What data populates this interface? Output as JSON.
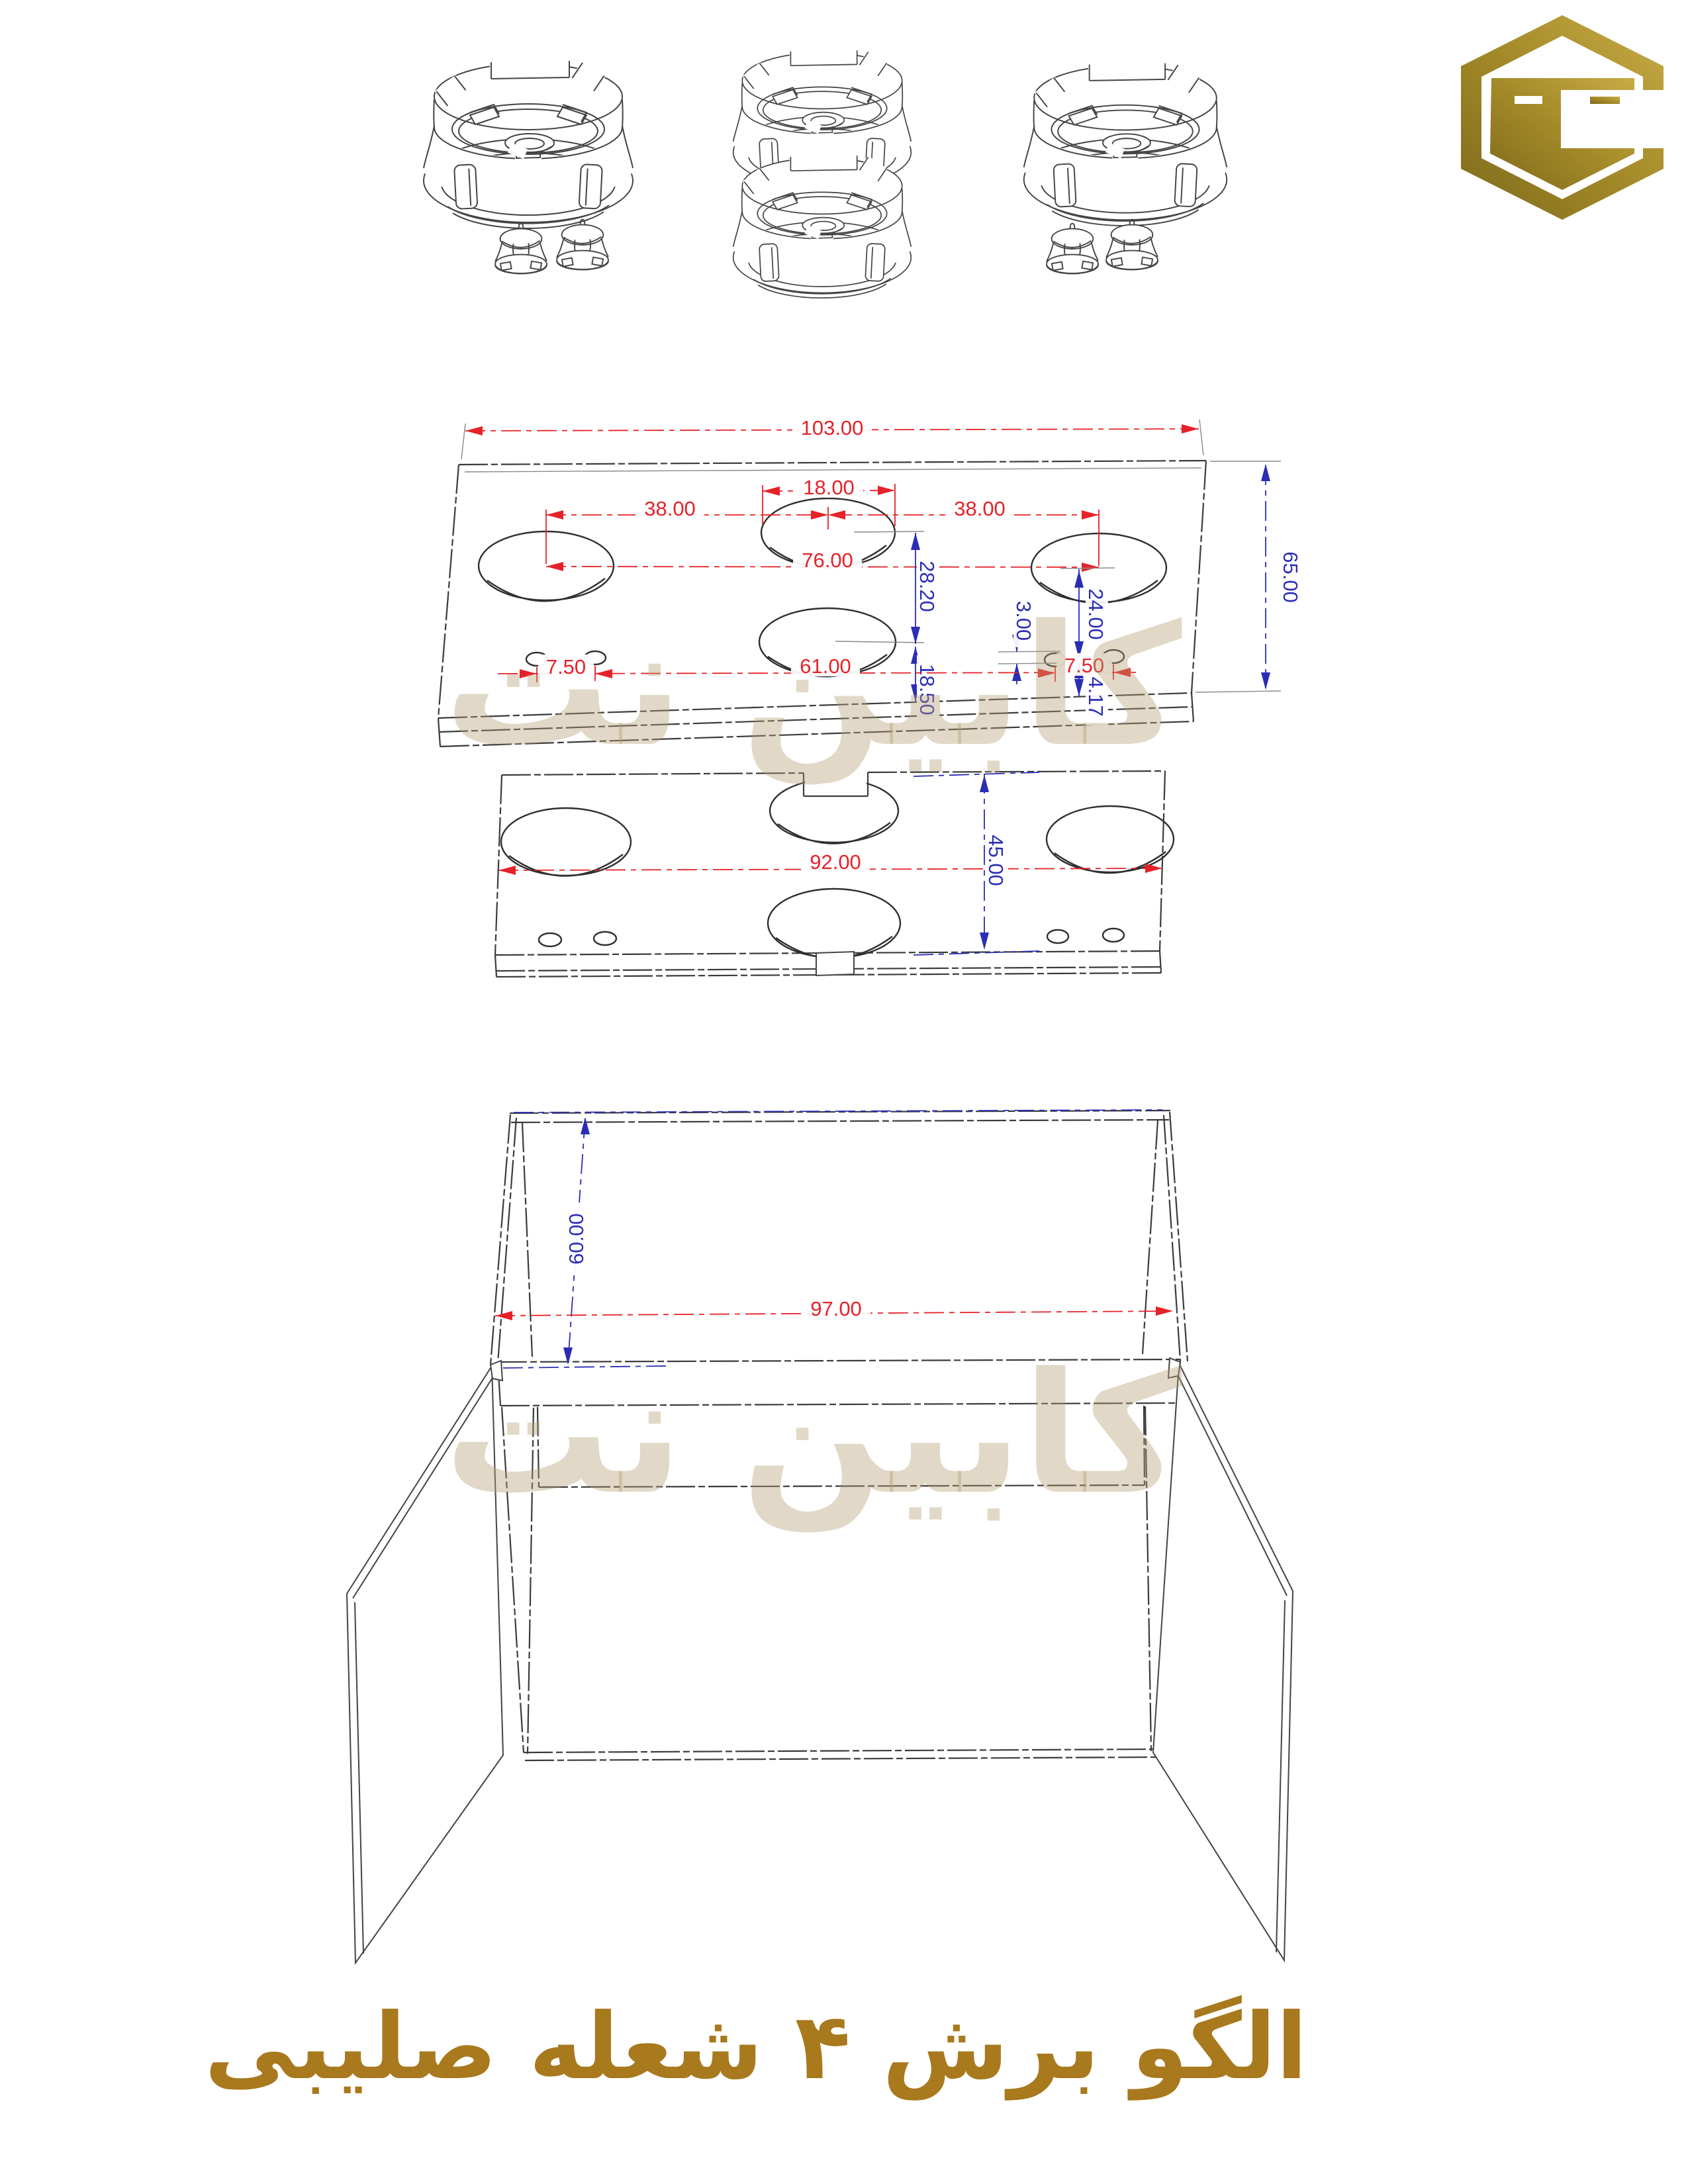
{
  "page": {
    "background": "#ffffff"
  },
  "logo": {
    "shape": "hexagon-c-monogram",
    "color_dark": "#7e691c",
    "color_mid": "#a38a28",
    "color_light": "#c7ab45"
  },
  "watermark": {
    "text": "کابین نت",
    "color": "#e6dccb"
  },
  "title": {
    "text": "الگو برش ۴ شعله صلیبی",
    "color": "#a8791d"
  },
  "colors": {
    "dimension_red": "#e62229",
    "dimension_blue": "#2b2db5",
    "line": "#3b3b3b"
  },
  "top_panel": {
    "dims": {
      "total_width": "103.00",
      "total_depth": "65.00",
      "center_hole_diameter": "18.00",
      "left_center_span": "38.00",
      "right_center_span": "38.00",
      "outer_centers_span": "76.00",
      "center_vertical_span": "28.20",
      "right_hole_to_knobs": "24.00",
      "knob_hole_height": "3.00",
      "center_to_back_edge": "18.50",
      "knobs_to_back_edge": "14.17",
      "left_knob_spacing": "7.50",
      "right_knob_spacing": "7.50",
      "knob_row_span": "61.00"
    }
  },
  "lower_panel": {
    "dims": {
      "total_width": "92.00",
      "total_depth": "45.00"
    }
  },
  "cabinet": {
    "dims": {
      "height": "60.00",
      "width": "97.00"
    }
  }
}
